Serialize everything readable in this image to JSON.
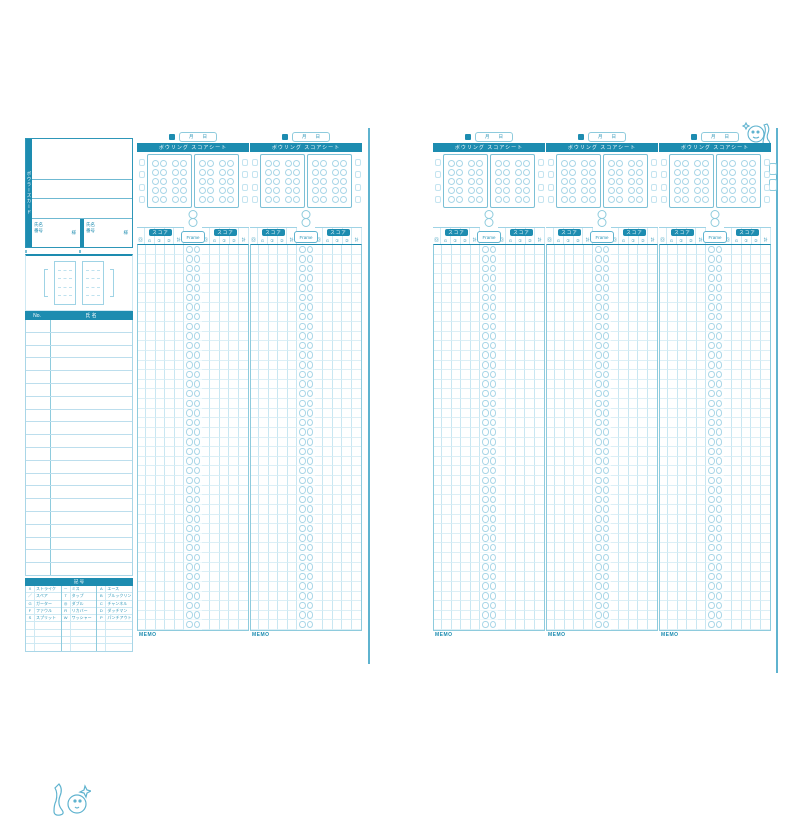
{
  "theme": {
    "accent": "#1d8cb0",
    "accent_dark": "#117399",
    "grid_light": "#cfe9f3",
    "grid_mid": "#9ed3e5",
    "background": "#ffffff"
  },
  "left_panel": {
    "side_label": "ボウラーズカード",
    "member_row": {
      "labels_top": "氏名",
      "labels_bottom": "番号",
      "suffix": "様"
    },
    "roster": {
      "no_label": "No.",
      "name_label": "氏 名",
      "row_count": 20
    },
    "legend": {
      "title": "記 号",
      "row_count": 9,
      "groups": [
        [
          [
            "X",
            "ストライク"
          ],
          [
            "／",
            "スペア"
          ],
          [
            "G",
            "ガーター"
          ],
          [
            "F",
            "ファウル"
          ],
          [
            "S",
            "スプリット"
          ]
        ],
        [
          [
            "－",
            "ミス"
          ],
          [
            "T",
            "タップ"
          ],
          [
            "◎",
            "ダブル"
          ],
          [
            "R",
            "リカバー"
          ],
          [
            "W",
            "ワッシャー"
          ]
        ],
        [
          [
            "A",
            "エース"
          ],
          [
            "B",
            "ブルックリン"
          ],
          [
            "C",
            "チャンネル"
          ],
          [
            "D",
            "ダッチマン"
          ],
          [
            "P",
            "パンチアウト"
          ]
        ]
      ]
    }
  },
  "column": {
    "date_label": "月　　日",
    "bar_title": "ボウリング スコアシート",
    "chip_label": "スコア",
    "frame_label": "Frame",
    "memo_label": "MEMO",
    "head_sub_labels": [
      "回",
      "G",
      "①",
      "②",
      "計"
    ],
    "pins": {
      "boxes": 2,
      "clusters_per_box": 2,
      "pins_per_cluster": 10,
      "margin_cells": 4
    },
    "grid": {
      "rows": 40,
      "side_columns": 5
    }
  },
  "columns": {
    "positions_px": [
      137,
      250,
      433,
      546,
      659
    ]
  }
}
